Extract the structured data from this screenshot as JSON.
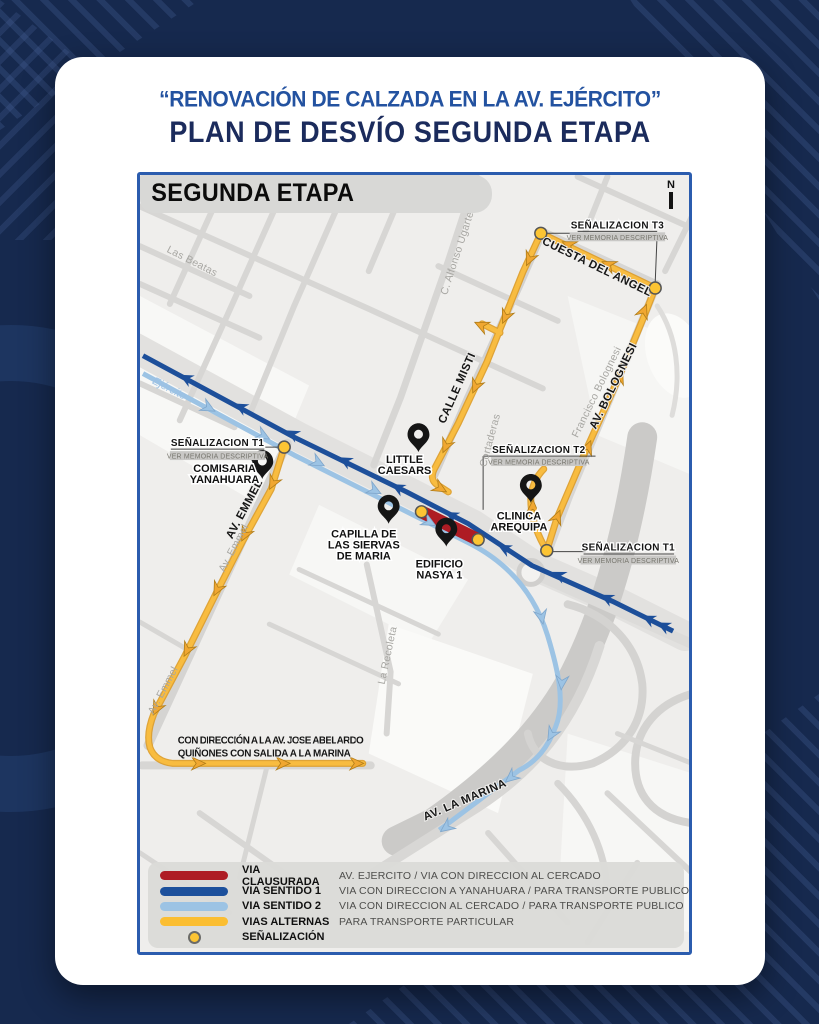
{
  "header": {
    "quote_title": "“RENOVACIÓN DE CALZADA EN LA AV. EJÉRCITO”",
    "main_title": "PLAN DE DESVÍO SEGUNDA ETAPA"
  },
  "map": {
    "stage_label": "SEGUNDA ETAPA",
    "compass_label": "N",
    "streets": {
      "las_beatas": "Las Beatas",
      "alfonso_ugarte": "C. Alfonso Ugarte",
      "cuesta_del_angel": "CUESTA DEL ANGEL",
      "calle_misti": "CALLE MISTI",
      "av_bolognesi": "AV. BOLOGNESI",
      "francisco_bolognesi": "Francisco Bolognesi",
      "cortaderas": "Cortaderas",
      "av_emmel": "AV. EMMEL",
      "av_emmel_minor": "Av. Emmel",
      "la_recoleta": "La Recoleta",
      "av_la_marina": "AV. LA MARINA",
      "ejercito": "Ejército"
    },
    "signals": [
      {
        "title": "SEÑALIZACION T3",
        "subtitle": "VER MEMORIA DESCRIPTIVA"
      },
      {
        "title": "SEÑALIZACION T2",
        "subtitle": "VER MEMORIA DESCRIPTIVA"
      },
      {
        "title": "SEÑALIZACION T1",
        "subtitle": "VER MEMORIA DESCRIPTIVA"
      },
      {
        "title": "SEÑALIZACION T1",
        "subtitle": "VER MEMORIA DESCRIPTIVA"
      }
    ],
    "pois": [
      {
        "name": "Little Caesars",
        "lines": [
          "LITTLE",
          "CAESARS"
        ]
      },
      {
        "name": "Comisaria Yanahuara",
        "lines": [
          "COMISARIA",
          "YANAHUARA"
        ]
      },
      {
        "name": "Capilla de las Siervas de Maria",
        "lines": [
          "CAPILLA DE",
          "LAS SIERVAS",
          "DE MARIA"
        ]
      },
      {
        "name": "Edificio Nasya 1",
        "lines": [
          "EDIFICIO",
          "NASYA 1"
        ]
      },
      {
        "name": "Clinica Arequipa",
        "lines": [
          "CLINICA",
          "AREQUIPA"
        ]
      }
    ],
    "note_lines": [
      "CON DIRECCIÓN A LA AV. JOSE ABELARDO",
      "QUIÑONES CON SALIDA A LA MARINA"
    ]
  },
  "legend": {
    "items": [
      {
        "label": "VIA CLAUSURADA",
        "description": "AV. EJERCITO / VIA CON DIRECCION AL CERCADO",
        "color": "#AE1C24",
        "swatch": "line"
      },
      {
        "label": "VIA SENTIDO 1",
        "description": "VIA CON DIRECCION A YANAHUARA / PARA TRANSPORTE PUBLICO",
        "color": "#1C509C",
        "swatch": "line"
      },
      {
        "label": "VIA SENTIDO 2",
        "description": "VIA CON DIRECCION AL CERCADO / PARA TRANSPORTE PUBLICO",
        "color": "#9CC3E4",
        "swatch": "line"
      },
      {
        "label": "VIAS ALTERNAS",
        "description": "PARA TRANSPORTE PARTICULAR",
        "color": "#FBBE32",
        "swatch": "line"
      },
      {
        "label": "SEÑALIZACIÓN",
        "description": "",
        "color": "#FCC433",
        "swatch": "dot"
      }
    ]
  },
  "colors": {
    "background": "#16294E",
    "card": "#FFFFFF",
    "map_border": "#2B5CAE",
    "via_clausurada": "#AE1C24",
    "via_sentido_1": "#1C509C",
    "via_sentido_2": "#9CC3E4",
    "vias_alternas": "#F6B73C",
    "senalizacion_dot": "#FCC433"
  }
}
